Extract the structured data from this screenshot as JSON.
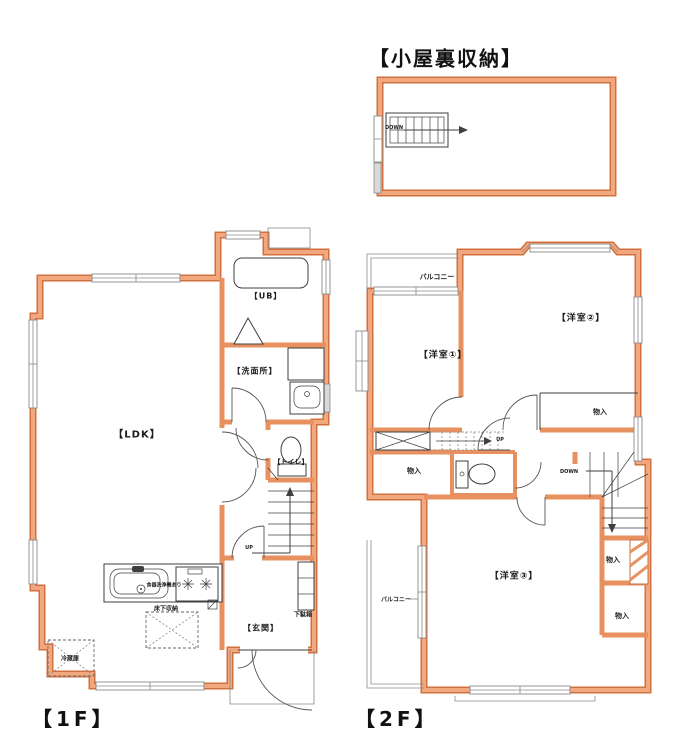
{
  "colors": {
    "wall_edge": "#D0703F",
    "wall_core": "#F3A77F",
    "wall_mid": "#E6915F",
    "ink": "#3F3F3F",
    "gray": "#8A8A8A"
  },
  "attic": {
    "title": "【小屋裏収納】",
    "down_label": "DOWN"
  },
  "floor1": {
    "label": "【1F】",
    "ldk": "【LDK】",
    "unit_bath": "【UB】",
    "washroom": "【洗面所】",
    "toilet": "【トイレ】",
    "entrance": "【玄関】",
    "shoe_cabinet": "下駄箱",
    "underfloor_storage": "床下収納",
    "refrigerator": "冷蔵庫",
    "dishwasher_note": "食器洗浄機あり",
    "up_label": "UP"
  },
  "floor2": {
    "label": "【2F】",
    "room1": "【洋室①】",
    "room2": "【洋室②】",
    "room3": "【洋室③】",
    "balcony": "バルコニー",
    "closet": "物入",
    "up_label": "UP",
    "down_label": "DOWN"
  }
}
